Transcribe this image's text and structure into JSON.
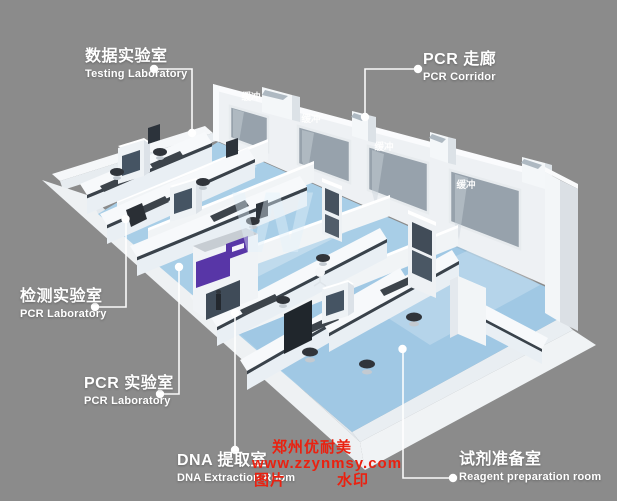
{
  "image_type": "3d-isometric-pcr-laboratory-floorplan-render",
  "scene": {
    "background_color": "#8b8b8b",
    "floor_color": "#a8cee7",
    "wall_color": "#f0f3f5",
    "window_color": "#97a2ac",
    "accent_purple": "#5836a7",
    "buffer_room_label": "缓冲",
    "buffer_room_count": 4
  },
  "callouts": [
    {
      "id": "testing-laboratory",
      "zh": "数据实验室",
      "en": "Testing Laboratory"
    },
    {
      "id": "pcr-corridor",
      "zh": "PCR 走廊",
      "en": "PCR Corridor"
    },
    {
      "id": "inspection-laboratory",
      "zh": "检测实验室",
      "en": "PCR Laboratory"
    },
    {
      "id": "pcr-laboratory",
      "zh": "PCR 实验室",
      "en": "PCR Laboratory"
    },
    {
      "id": "dna-extraction-room",
      "zh": "DNA 提取室",
      "en": "DNA Extraction Room"
    },
    {
      "id": "reagent-preparation-room",
      "zh": "试剂准备室",
      "en": "Reagent preparation room"
    }
  ],
  "watermark": {
    "company": "郑州优耐美",
    "website": "www.zzynmsy.com",
    "label_left": "图片",
    "label_right": "水印",
    "big_letter": "W",
    "color": "#ea2110"
  }
}
